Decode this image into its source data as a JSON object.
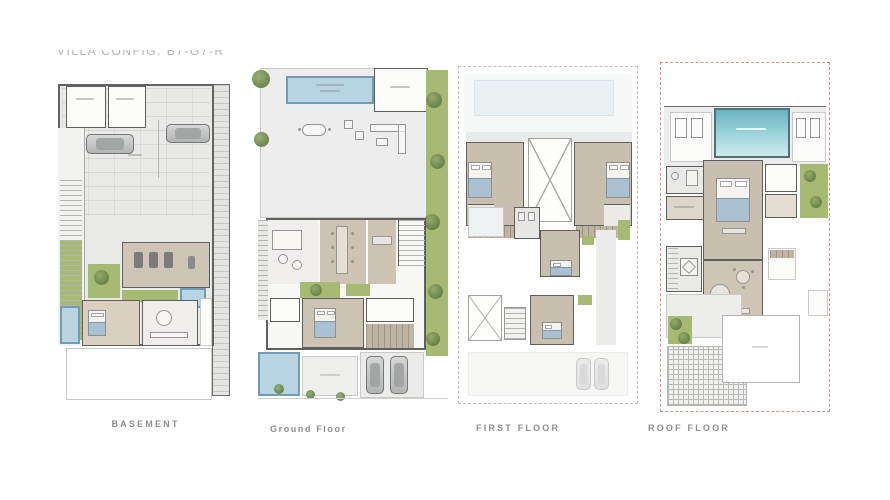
{
  "header": {
    "title": "VILLA CONFIG: B7-G7-R"
  },
  "plans": [
    {
      "id": "basement",
      "label": "BASEMENT"
    },
    {
      "id": "ground-floor",
      "label": "Ground Floor"
    },
    {
      "id": "first-floor",
      "label": "FIRST FLOOR"
    },
    {
      "id": "roof-floor",
      "label": "ROOF FLOOR"
    }
  ],
  "palette": {
    "background": "#ffffff",
    "plan_fill": "#e9e9e7",
    "wall": "#5f5f5d",
    "beige_floor": "#c9bfae",
    "lawn_green": "#a7ba74",
    "tree_green": "#5e7b41",
    "pool_blue": "#b7d4e3",
    "pool_border": "#6f9cb3",
    "roof_pool_teal": "#69b4c0",
    "boundary_red": "#d09090",
    "label_gray": "#8f8f8f"
  }
}
